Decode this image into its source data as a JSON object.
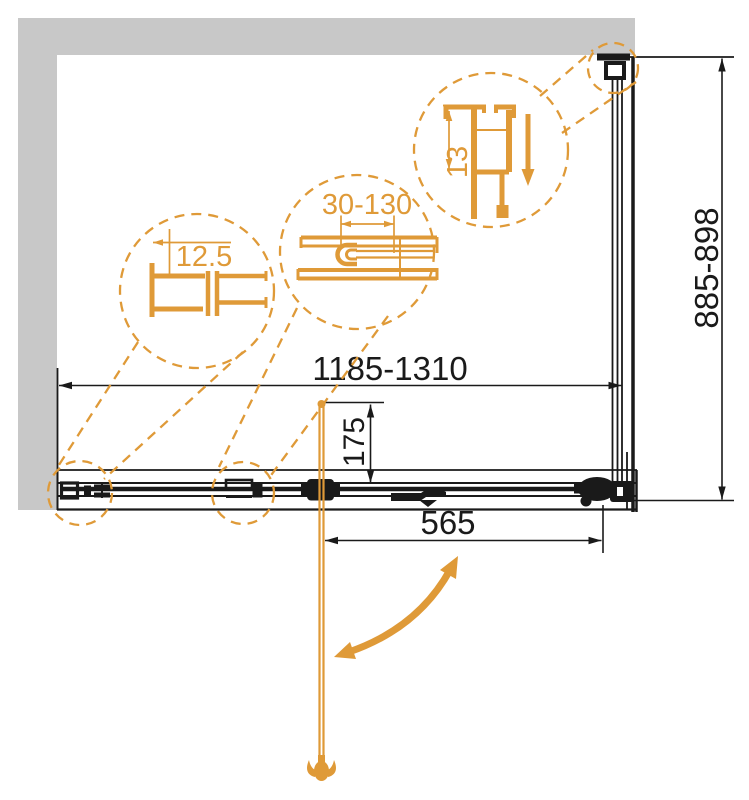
{
  "labels": {
    "width_range": "1185-1310",
    "height_range": "885-898",
    "door_width": "565",
    "handle_offset": "175",
    "detail_wall_profile": "12.5",
    "detail_adjustment": "30-130",
    "detail_top_profile": "13"
  },
  "colors": {
    "accent_orange": "#DF9A38",
    "line_black": "#1A1A1A",
    "wall_gray": "#C8C8C8",
    "background": "#FFFFFF"
  }
}
